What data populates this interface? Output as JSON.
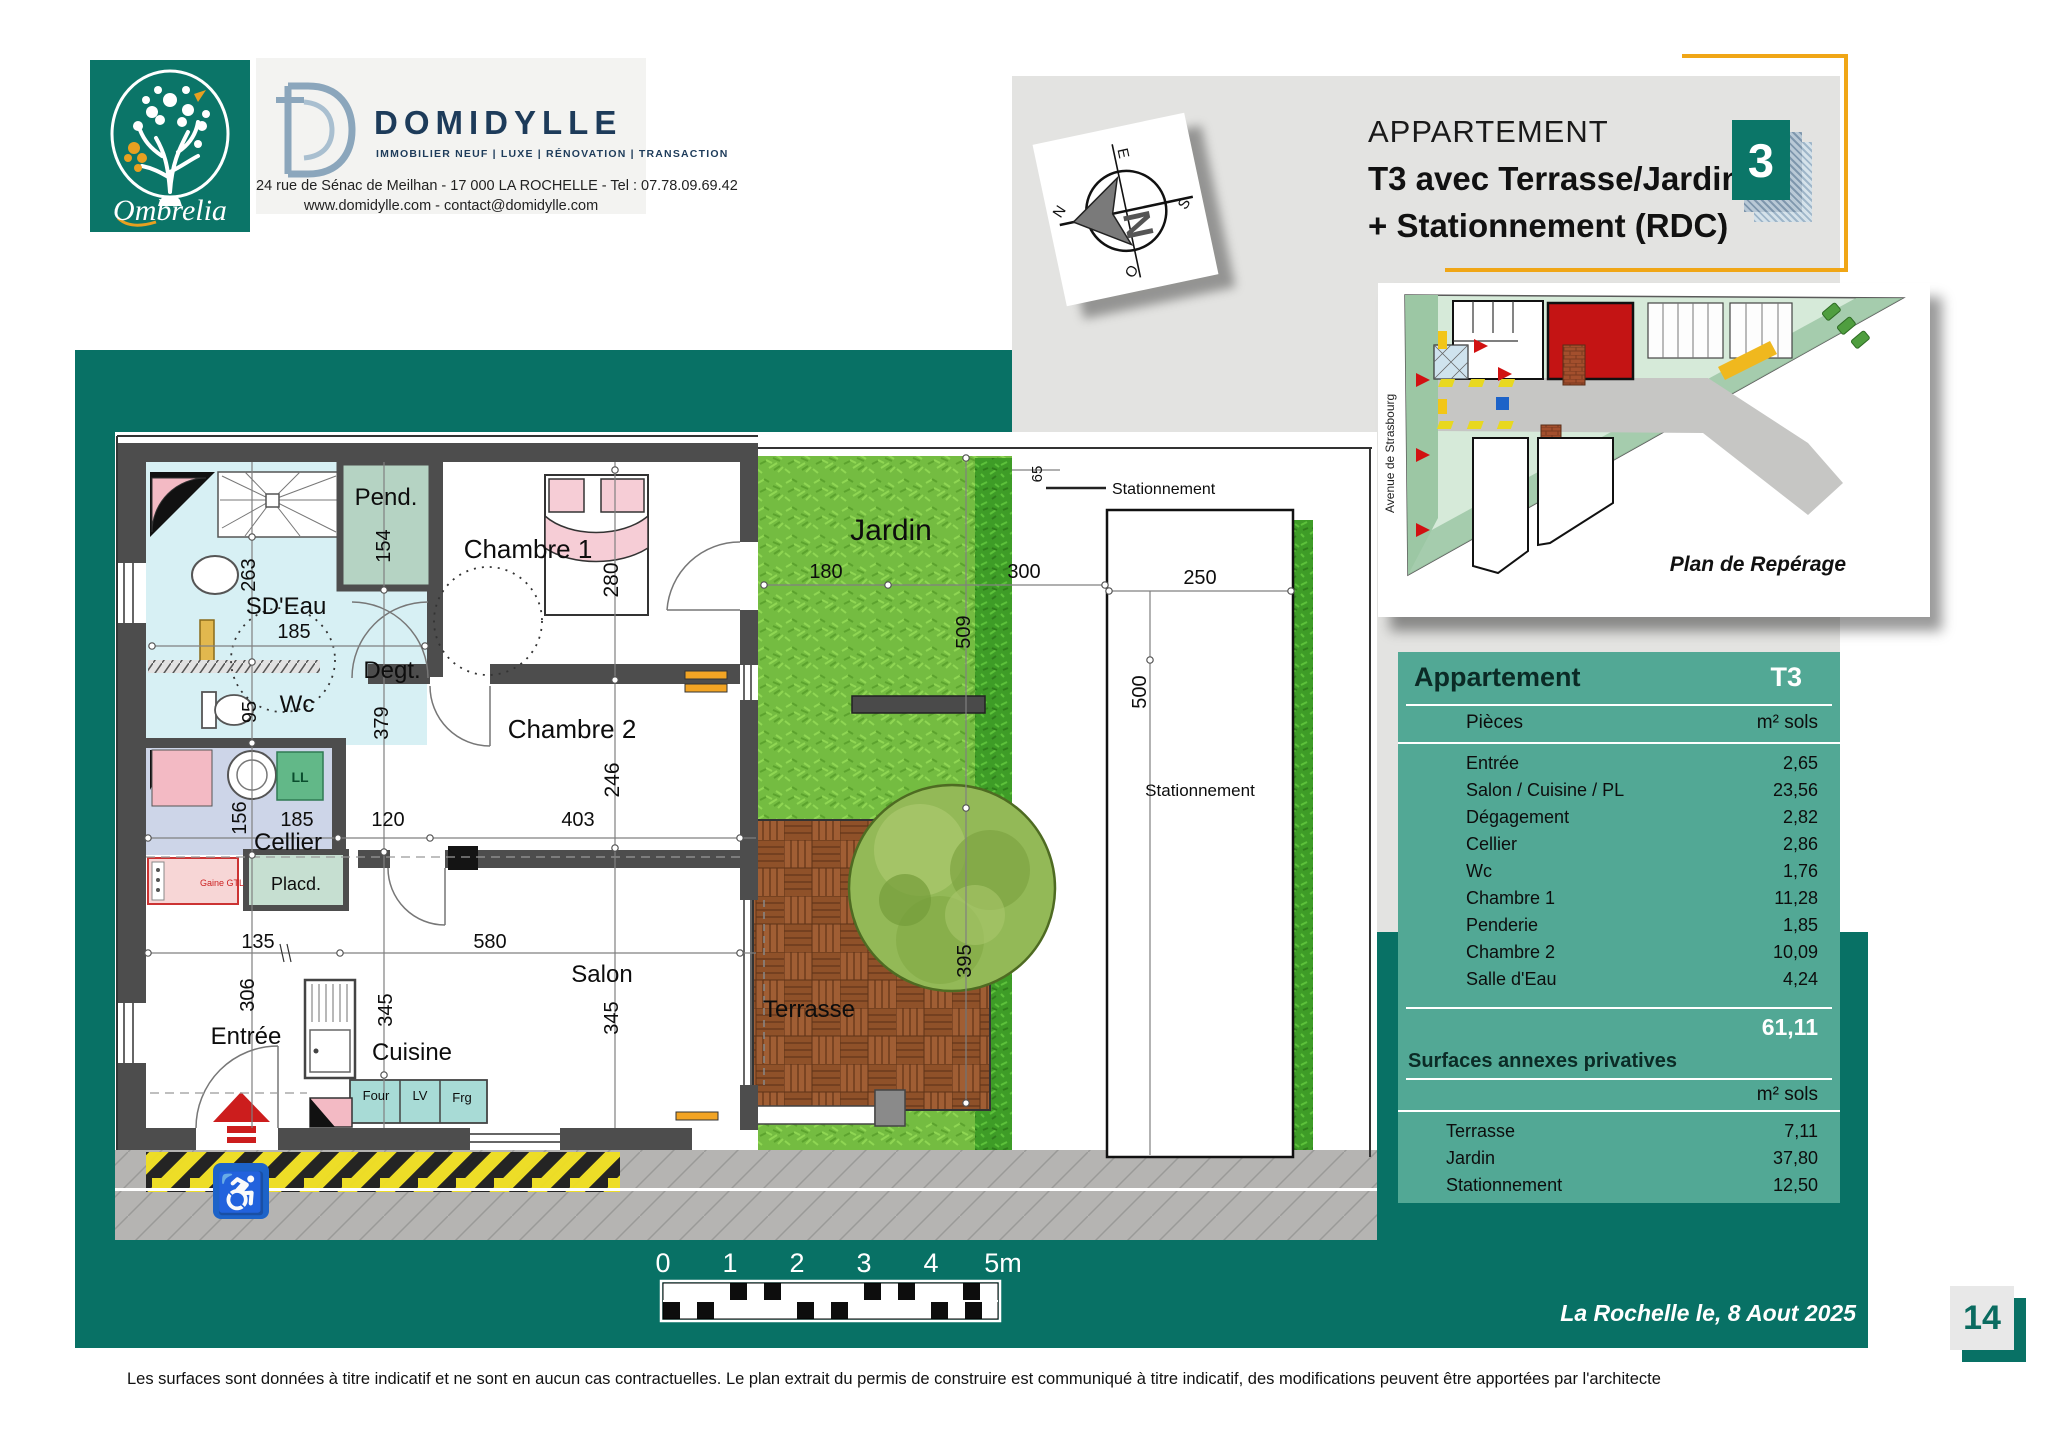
{
  "branding": {
    "ombrelia_name": "Ombrelia",
    "domidylle_name": "DOMIDYLLE",
    "domidylle_tagline": "IMMOBILIER NEUF | LUXE | RÉNOVATION | TRANSACTION",
    "domidylle_address": "24 rue de Sénac de Meilhan - 17 000  LA ROCHELLE - Tel : 07.78.09.69.42",
    "domidylle_web": "www.domidylle.com - contact@domidylle.com"
  },
  "header": {
    "title_line1": "APPARTEMENT",
    "title_line2": "T3 avec Terrasse/Jardin",
    "title_line3": "+ Stationnement  (RDC)",
    "lot_number": "3"
  },
  "compass": {
    "north": "N",
    "south": "S",
    "east": "E",
    "west": "O"
  },
  "site_plan": {
    "street": "Avenue  de  Strasbourg",
    "caption": "Plan de Repérage"
  },
  "floor_plan": {
    "rooms": {
      "pend": "Pend.",
      "chambre1": "Chambre 1",
      "sdeau": "SD'Eau",
      "degt": "Degt.",
      "wc": "Wc",
      "cellier": "Cellier",
      "placard": "Placd.",
      "gaine": "Gaine GTL",
      "chambre2": "Chambre 2",
      "salon": "Salon",
      "cuisine": "Cuisine",
      "entree": "Entrée",
      "jardin": "Jardin",
      "terrasse": "Terrasse",
      "stationnement": "Stationnement",
      "stationnement_callout": "Stationnement"
    },
    "appliances": {
      "ll": "LL",
      "four": "Four",
      "lv": "LV",
      "frg": "Frg"
    },
    "dimensions": {
      "pend_width": "154",
      "sdeau_height": "263",
      "sdeau_width": "185",
      "wc_height": "95",
      "degt_height": "379",
      "cellier_height": "156",
      "cellier_width": "185",
      "degt_width": "120",
      "chambre2_width": "403",
      "chambre1_height": "280",
      "chambre2_height": "246",
      "entree_width": "135",
      "salon_width": "580",
      "entree_height": "306",
      "cuisine_height": "345",
      "salon_height": "345",
      "jardin_width_left": "180",
      "jardin_width_right": "300",
      "jardin_height": "509",
      "terrasse_height": "395",
      "strip_width": "65",
      "parking_width": "250",
      "parking_height": "500"
    }
  },
  "scale_bar": {
    "labels": [
      "0",
      "1",
      "2",
      "3",
      "4",
      "5m"
    ]
  },
  "surface_table": {
    "title": "Appartement",
    "type": "T3",
    "col_label": "Pièces",
    "col_unit": "m² sols",
    "rows": [
      {
        "label": "Entrée",
        "value": "2,65"
      },
      {
        "label": "Salon / Cuisine / PL",
        "value": "23,56"
      },
      {
        "label": "Dégagement",
        "value": "2,82"
      },
      {
        "label": "Cellier",
        "value": "2,86"
      },
      {
        "label": "Wc",
        "value": "1,76"
      },
      {
        "label": "Chambre 1",
        "value": "11,28"
      },
      {
        "label": "Penderie",
        "value": "1,85"
      },
      {
        "label": "Chambre 2",
        "value": "10,09"
      },
      {
        "label": "Salle d'Eau",
        "value": "4,24"
      }
    ],
    "total": "61,11",
    "annex_title": "Surfaces annexes privatives",
    "annex_unit": "m² sols",
    "annex_rows": [
      {
        "label": "Terrasse",
        "value": "7,11"
      },
      {
        "label": "Jardin",
        "value": "37,80"
      },
      {
        "label": "Stationnement",
        "value": "12,50"
      }
    ]
  },
  "footer": {
    "date_line": "La Rochelle  le, 8 Aout 2025",
    "page_number": "14",
    "disclaimer": "Les  surfaces  sont  données à  titre  indicatif et ne sont en  aucun  cas  contractuelles. Le plan extrait  du permis de  construire est  communiqué à  titre indicatif, des  modifications peuvent être apportées par l'architecte"
  }
}
